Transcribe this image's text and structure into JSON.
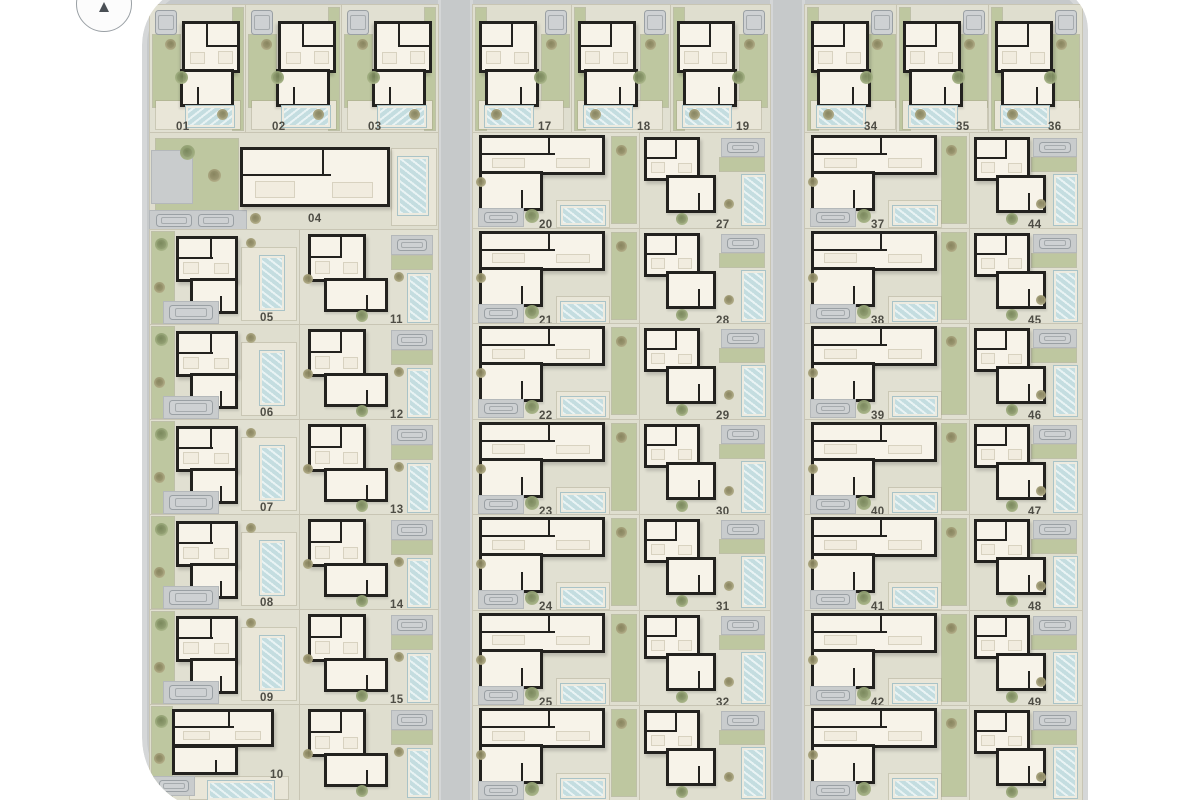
{
  "site": {
    "type": "residential-development-site-plan",
    "compass_icon": "north-arrow",
    "colors": {
      "page_bg": "#ffffff",
      "road": "#c6c9ca",
      "sidewalk": "#d5d7d8",
      "plot_ground": "#e1e0d2",
      "garden": "#bec7a0",
      "house_wall": "#23221f",
      "house_floor": "#f7f3e9",
      "pool_water": "#d3e7e9",
      "pool_edge": "#a9c3c7",
      "car": "#ced1d3",
      "label_text": "#4e4d45"
    },
    "blocks": [
      {
        "name": "west-block",
        "top_row_plots": [
          "01",
          "02",
          "03"
        ],
        "clubhouse_plot": "04",
        "left_column_plots": [
          "05",
          "06",
          "07",
          "08",
          "09",
          "10"
        ],
        "right_column_plots": [
          "11",
          "12",
          "13",
          "14",
          "15",
          ""
        ]
      },
      {
        "name": "center-block",
        "top_row_plots": [
          "17",
          "18",
          "19"
        ],
        "left_column_plots": [
          "20",
          "21",
          "22",
          "23",
          "24",
          "25",
          ""
        ],
        "right_column_plots": [
          "27",
          "28",
          "29",
          "30",
          "31",
          "32",
          ""
        ]
      },
      {
        "name": "east-block",
        "top_row_plots": [
          "34",
          "35",
          "36"
        ],
        "left_column_plots": [
          "37",
          "38",
          "39",
          "40",
          "41",
          "42",
          ""
        ],
        "right_column_plots": [
          "44",
          "45",
          "46",
          "47",
          "48",
          "49",
          ""
        ]
      }
    ]
  }
}
